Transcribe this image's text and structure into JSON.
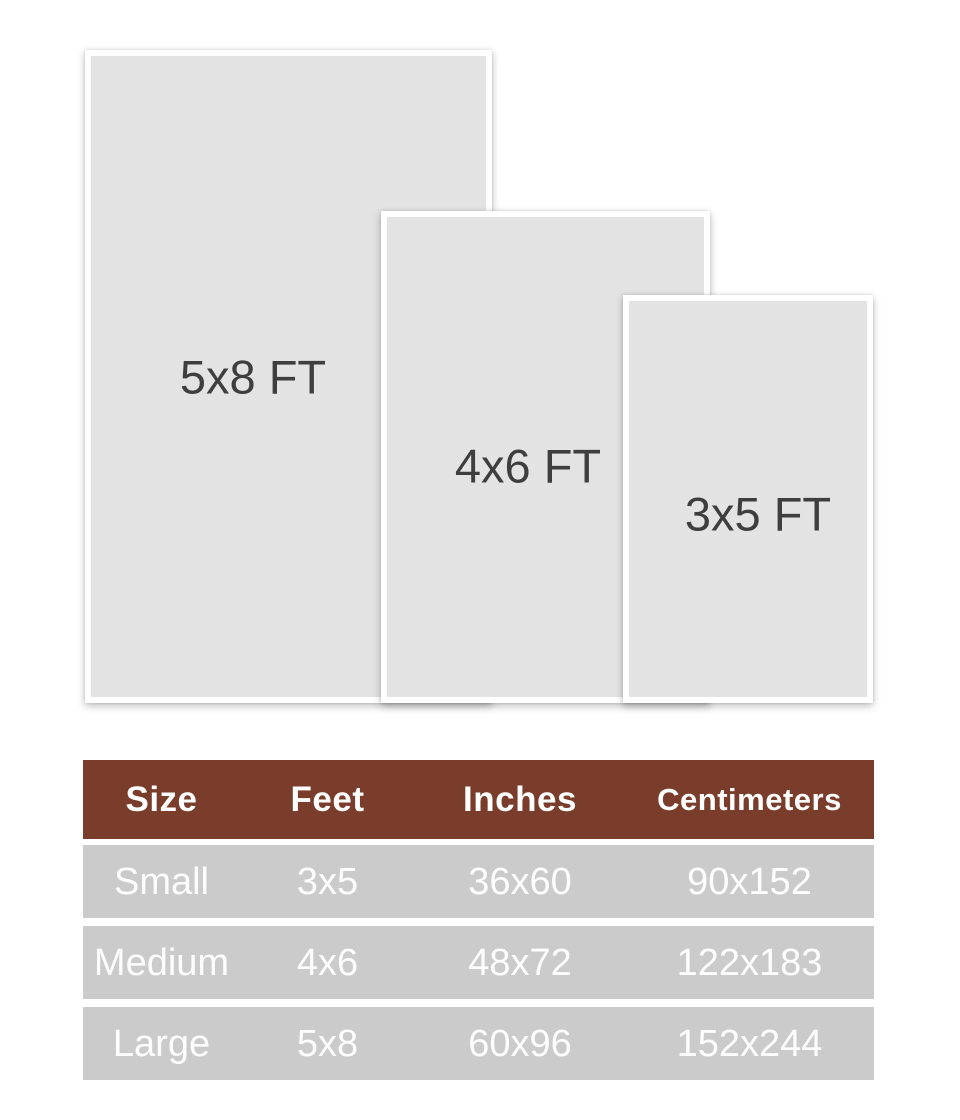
{
  "colors": {
    "page_bg": "#FFFFFF",
    "rug_fill": "#E3E3E3",
    "rug_border": "#FFFFFF",
    "rug_label_text": "#3E3E3E",
    "table_header_bg": "#7B3D2B",
    "table_header_text": "#FFFFFF",
    "table_row_bg": "#CBCBCB",
    "table_row_text": "#FFFFFF"
  },
  "diagram": {
    "rugs": [
      {
        "label": "5x8 FT"
      },
      {
        "label": "4x6 FT"
      },
      {
        "label": "3x5 FT"
      }
    ]
  },
  "table": {
    "headers": [
      "Size",
      "Feet",
      "Inches",
      "Centimeters"
    ],
    "rows": [
      [
        "Small",
        "3x5",
        "36x60",
        "90x152"
      ],
      [
        "Medium",
        "4x6",
        "48x72",
        "122x183"
      ],
      [
        "Large",
        "5x8",
        "60x96",
        "152x244"
      ]
    ]
  },
  "chart_data": {
    "type": "table",
    "title": "Rug size chart",
    "columns": [
      "Size",
      "Feet",
      "Inches",
      "Centimeters"
    ],
    "rows": [
      [
        "Small",
        "3x5",
        "36x60",
        "90x152"
      ],
      [
        "Medium",
        "4x6",
        "48x72",
        "122x183"
      ],
      [
        "Large",
        "5x8",
        "60x96",
        "152x244"
      ]
    ],
    "diagram": {
      "type": "nested-rectangles",
      "items": [
        {
          "label": "5x8 FT",
          "relative_size": "largest"
        },
        {
          "label": "4x6 FT",
          "relative_size": "medium"
        },
        {
          "label": "3x5 FT",
          "relative_size": "smallest"
        }
      ]
    }
  }
}
